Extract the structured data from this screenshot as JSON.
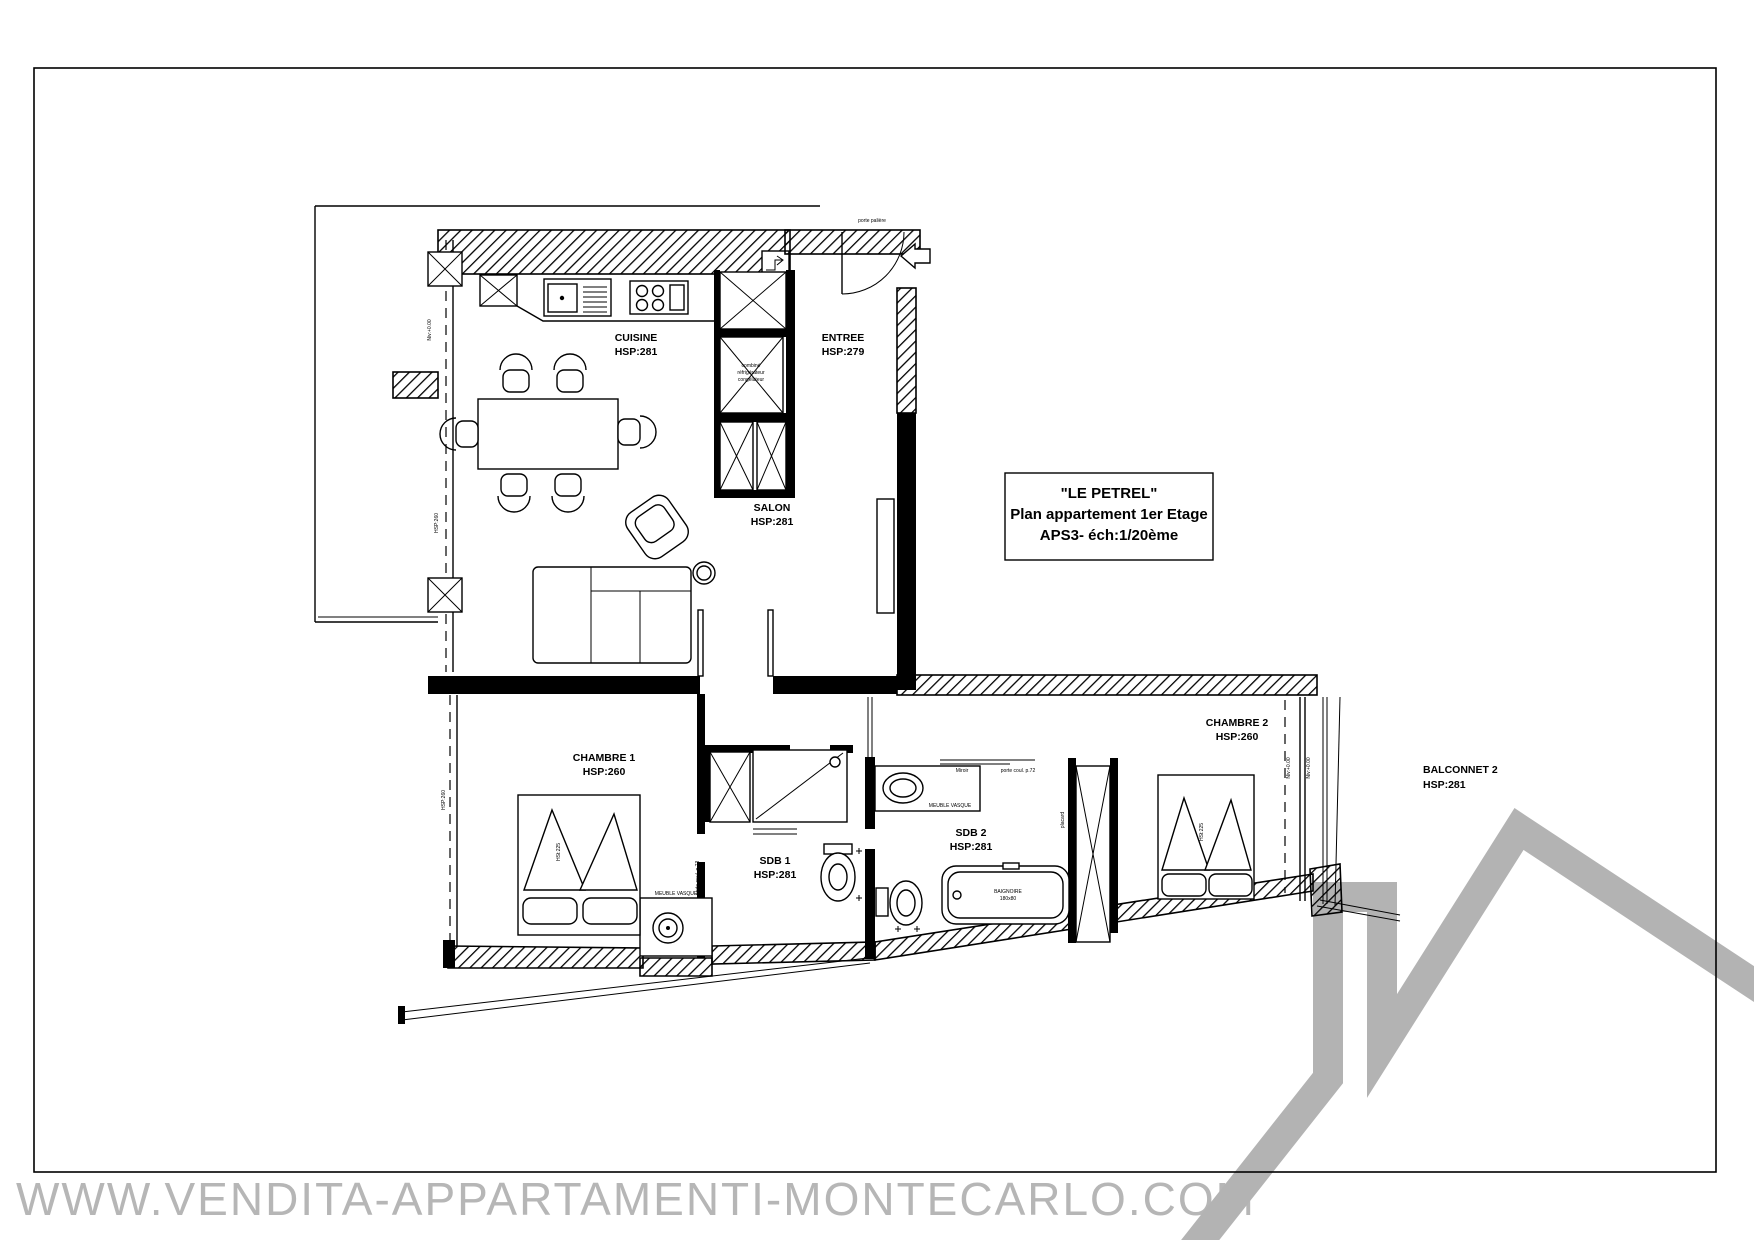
{
  "document": {
    "watermark": "WWW.VENDITA-APPARTAMENTI-MONTECARLO.COM",
    "colors": {
      "ink": "#000000",
      "paper": "#ffffff",
      "watermark_gray": "#b6b6b6",
      "logo_gray": "#b3b3b3"
    }
  },
  "title_block": {
    "name": "\"LE PETREL\"",
    "line2": "Plan appartement 1er Etage",
    "line3": "APS3- éch:1/20ème"
  },
  "rooms": [
    {
      "id": "cuisine",
      "label": "CUISINE",
      "hsp": "HSP:281"
    },
    {
      "id": "entree",
      "label": "ENTREE",
      "hsp": "HSP:279"
    },
    {
      "id": "salon",
      "label": "SALON",
      "hsp": "HSP:281"
    },
    {
      "id": "chambre-1",
      "label": "CHAMBRE 1",
      "hsp": "HSP:260"
    },
    {
      "id": "sdb-1",
      "label": "SDB 1",
      "hsp": "HSP:281"
    },
    {
      "id": "sdb-2",
      "label": "SDB 2",
      "hsp": "HSP:281"
    },
    {
      "id": "chambre-2",
      "label": "CHAMBRE 2",
      "hsp": "HSP:260"
    },
    {
      "id": "balconnet-2",
      "label": "BALCONNET 2",
      "hsp": "HSP:281"
    }
  ],
  "annotations": {
    "porte_paliere": "porte palière",
    "porte_coulissante_72": "porte coul. p.72",
    "porte_coulissante_73": "porte coul. p.73",
    "meuble_vasque": "MEUBLE VASQUE",
    "miroir": "Miroir",
    "placard": "placard",
    "refrigerator_line1": "combiné",
    "refrigerator_line2": "réfrigérateur",
    "refrigerator_line3": "congélateur",
    "bathtub_line1": "BAIGNOIRE",
    "bathtub_line2": "180x80",
    "level": "Niv:+0.00",
    "ceiling_note": "HSP:260",
    "bed_note": "HSt:225"
  }
}
